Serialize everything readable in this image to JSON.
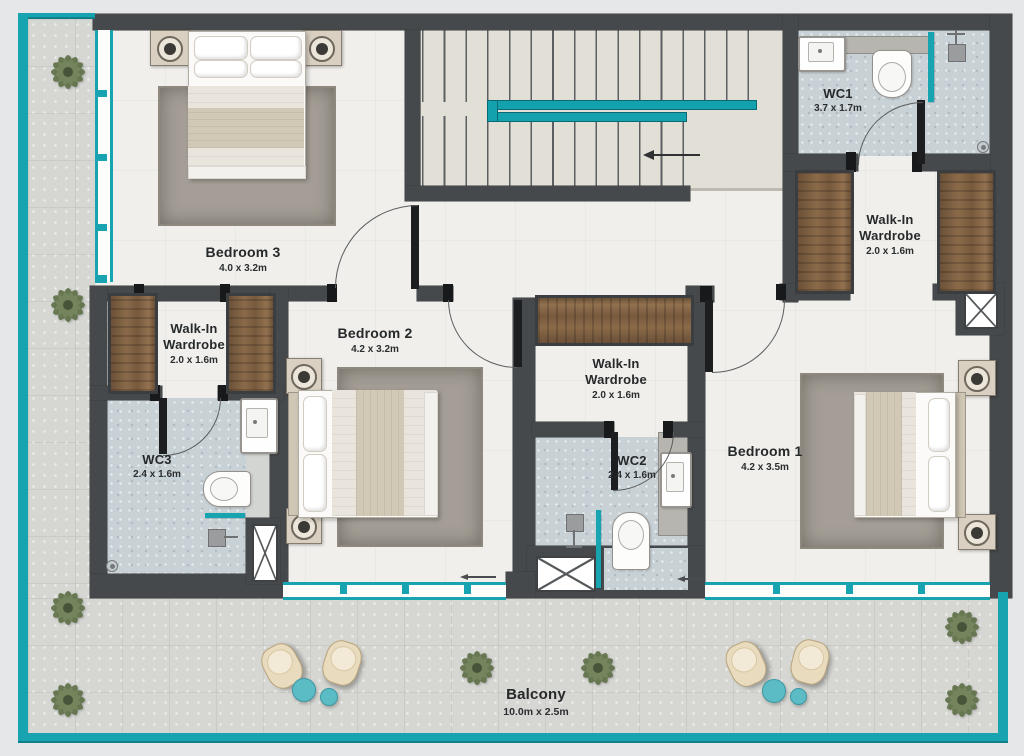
{
  "plan": {
    "rooms": {
      "bedroom1": {
        "name": "Bedroom 1",
        "dims": "4.2 x 3.5m"
      },
      "bedroom2": {
        "name": "Bedroom 2",
        "dims": "4.2 x 3.2m"
      },
      "bedroom3": {
        "name": "Bedroom 3",
        "dims": "4.0 x 3.2m"
      },
      "wc1": {
        "name": "WC1",
        "dims": "3.7 x 1.7m"
      },
      "wc2": {
        "name": "WC2",
        "dims": "2.4 x 1.6m"
      },
      "wc3": {
        "name": "WC3",
        "dims": "2.4 x 1.6m"
      },
      "wardrobe_left": {
        "line1": "Walk-In",
        "line2": "Wardrobe",
        "dims": "2.0 x 1.6m"
      },
      "wardrobe_mid": {
        "line1": "Walk-In",
        "line2": "Wardrobe",
        "dims": "2.0 x 1.6m"
      },
      "wardrobe_right": {
        "line1": "Walk-In",
        "line2": "Wardrobe",
        "dims": "2.0 x 1.6m"
      },
      "balcony": {
        "name": "Balcony",
        "dims": "10.0m x 2.5m"
      }
    },
    "colors": {
      "teal": "#18a3b0",
      "wall": "#46494b",
      "wood": "#7d6043",
      "bath_floor": "#c8d1d5"
    }
  }
}
